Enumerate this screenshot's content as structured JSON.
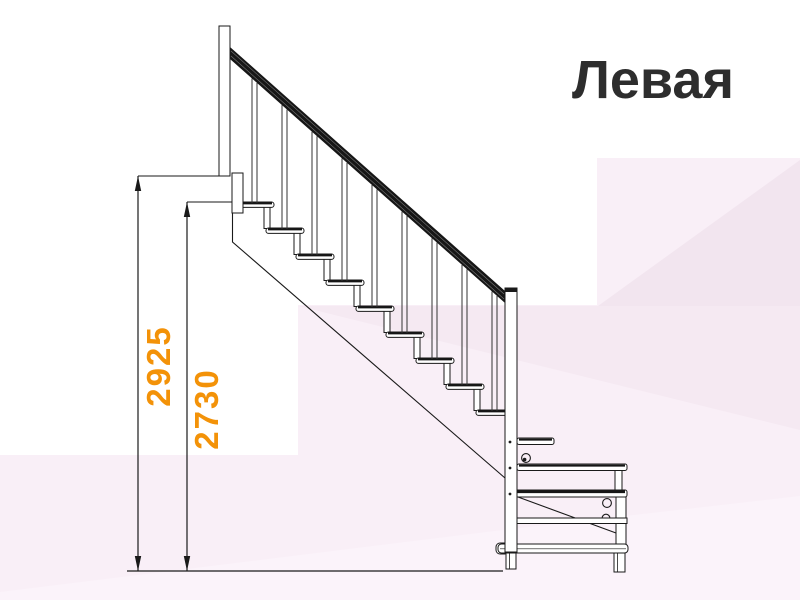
{
  "title": "Левая",
  "dimensions": [
    {
      "id": "overall-height",
      "value": "2925"
    },
    {
      "id": "floor-to-top-tread",
      "value": "2730"
    }
  ],
  "drawing": {
    "name": "staircase-side-view",
    "tread_count": 9,
    "baluster_count": 9,
    "platform_step_count": 3
  },
  "colors": {
    "dimension_text": "#F39208",
    "title_text": "#2D2D2D",
    "drawing_line": "#1A1A1A",
    "background_pink_light": "#F9EFF7",
    "background_pink_mid": "#F5E9F2",
    "background_pink_dark": "#F2E5EF",
    "background_pink_bottom": "#FBF3FA"
  }
}
